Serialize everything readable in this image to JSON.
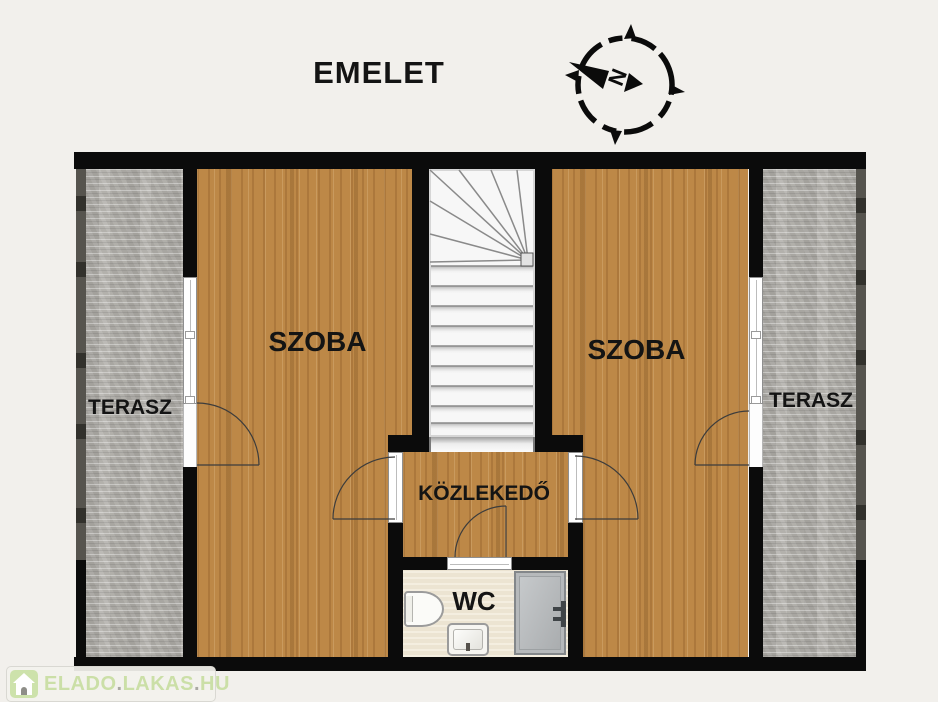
{
  "title": "EMELET",
  "compass": {
    "direction_label": "N"
  },
  "rooms": {
    "terrace_left": {
      "label": "TERASZ"
    },
    "room_left": {
      "label": "SZOBA"
    },
    "room_right": {
      "label": "SZOBA"
    },
    "terrace_right": {
      "label": "TERASZ"
    },
    "hallway": {
      "label": "KÖZLEKEDŐ"
    },
    "wc": {
      "label": "WC"
    }
  },
  "watermark": {
    "text_parts": [
      "ELADO",
      ".",
      "LAKAS",
      ".",
      "HU"
    ]
  },
  "colors": {
    "background": "#f2f0ec",
    "wall": "#0b0b0b",
    "wood_floor": "#bd8847",
    "terrace_stone": "#b4b2ad",
    "wc_floor": "#f1e9d6",
    "shower_gray": "#b6b9bb",
    "watermark_green": "#cbdfa7"
  }
}
